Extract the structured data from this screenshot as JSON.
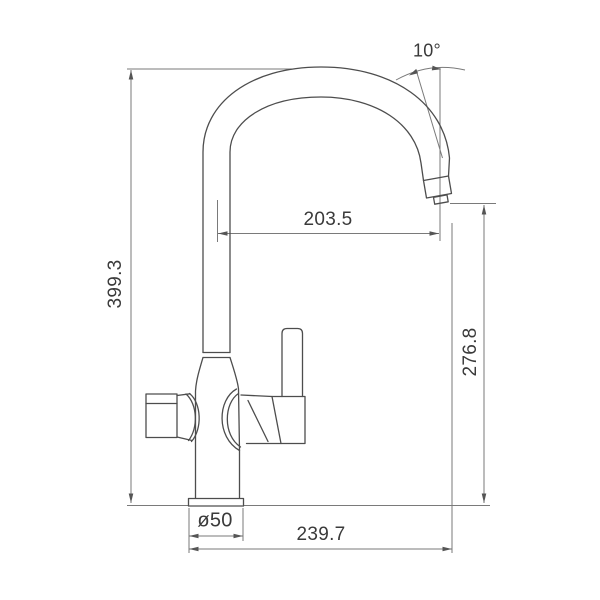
{
  "drawing": {
    "type": "faucet-technical-dimension-drawing",
    "labels": {
      "angle": "10°",
      "spout_reach": "203.5",
      "total_height": "399.3",
      "spout_height": "276.8",
      "base_diameter": "ø50",
      "total_projection": "239.7"
    },
    "colors": {
      "outline": "#4d4d4d",
      "dimension_lines": "#7a7a7a",
      "text": "#3a3a3a",
      "background": "#ffffff"
    }
  }
}
